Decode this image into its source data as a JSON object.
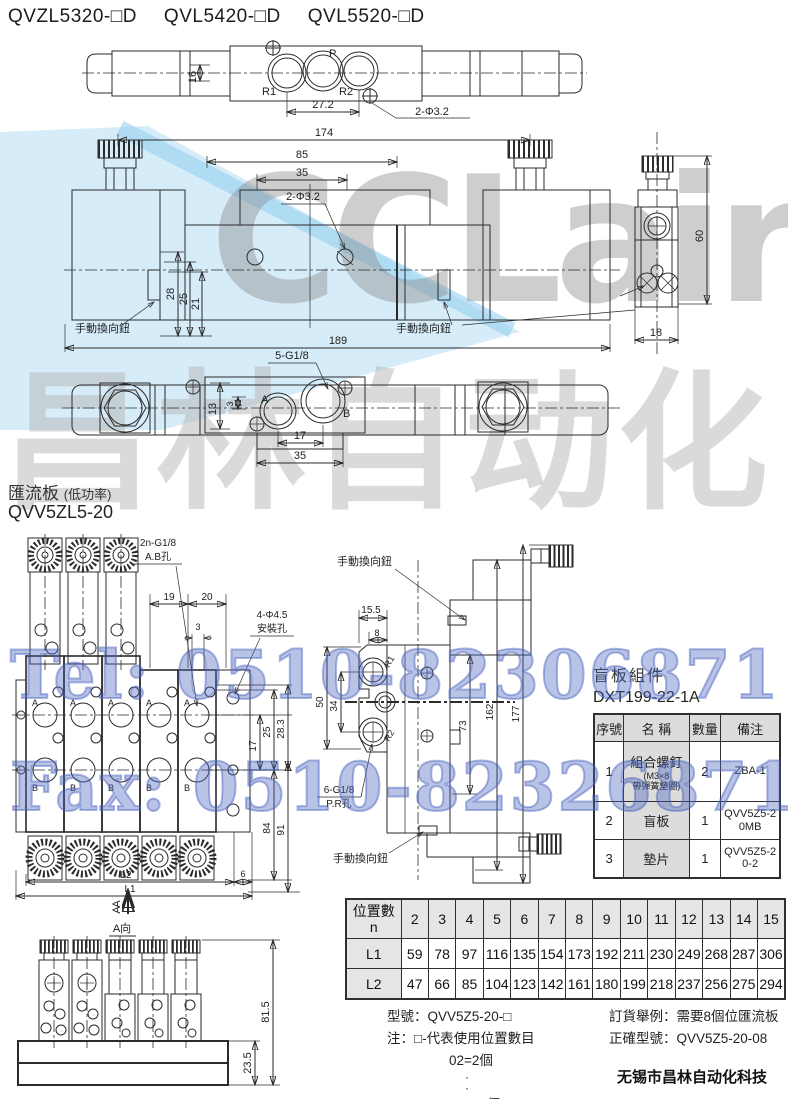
{
  "header": {
    "models": [
      "QVZL5320-□D",
      "QVL5420-□D",
      "QVL5520-□D"
    ]
  },
  "watermarks": {
    "brand": "CCLair",
    "brand_cn": "昌林自动化",
    "tel": "Tel: 0510-82306871",
    "fax": "Fax: 0510-82326871"
  },
  "colors": {
    "line": "#2b2b2b",
    "swoosh": "#cfe9f8",
    "swoosh_edge": "#8fcdef",
    "table_gray": "#e5e5e5",
    "contact_blue": "#4860bc"
  },
  "top_view": {
    "port_r1": "R1",
    "port_p": "P",
    "port_r2": "R2",
    "dim16": "16",
    "dim272": "27.2",
    "holes": "2-Φ3.2"
  },
  "front_view": {
    "dim174": "174",
    "dim85": "85",
    "dim35": "35",
    "holes": "2-Φ3.2",
    "dim28": "28",
    "dim25": "25",
    "dim21": "21",
    "dim189": "189",
    "knob_left": "手動換向鈕",
    "knob_right": "手動換向鈕"
  },
  "side_view": {
    "dim60": "60",
    "dim18": "18"
  },
  "bottom_view": {
    "thread": "5-G1/8",
    "port_a": "A",
    "port_b": "B",
    "dim13": "13",
    "dim3": "3",
    "dim17": "17",
    "dim35": "35"
  },
  "section": {
    "title": "匯流板",
    "note": "(低功率)",
    "model": "QVV5ZL5-20"
  },
  "manifold_top": {
    "thread": "2n-G1/8",
    "thread_sub": "A.B孔",
    "dim19": "19",
    "dim20": "20",
    "dim3": "3",
    "mount": "4-Φ4.5",
    "mount_sub": "安裝孔",
    "dim283": "28.3",
    "dim25": "25",
    "dim17": "17",
    "dim84": "84",
    "dim91": "91",
    "dimL2": "L2",
    "dim6": "6",
    "dimL1": "L1",
    "view_arrow": "A",
    "port_a": "A",
    "port_b": "B"
  },
  "manifold_side": {
    "knob_top": "手動換向鈕",
    "knob_bottom": "手動換向鈕",
    "dim155": "15.5",
    "dim8": "8",
    "dim50": "50",
    "dim34": "34",
    "dim73": "73",
    "dim162": "162",
    "dim177": "177",
    "port_r1": "R1",
    "port_p": "P",
    "port_r2": "R2",
    "thread": "6-G1/8",
    "thread_sub": "P.R孔"
  },
  "blank_plate": {
    "title": "盲板組件",
    "part_no": "DXT199-22-1A",
    "headers": [
      "序號",
      "名 稱",
      "數量",
      "備注"
    ],
    "rows": [
      {
        "no": "1",
        "name": "組合螺釘",
        "sub": "(M3×8",
        "sub2": "帶彈簧墊圈)",
        "qty": "2",
        "note": "ZBA-1"
      },
      {
        "no": "2",
        "name": "盲板",
        "qty": "1",
        "note": "QVV5Z5-20MB"
      },
      {
        "no": "3",
        "name": "墊片",
        "qty": "1",
        "note": "QVV5Z5-20-2"
      }
    ]
  },
  "a_view": {
    "label": "A向",
    "arrow": "A",
    "dim815": "81.5",
    "dim235": "23.5"
  },
  "size_table": {
    "corner": "位置數",
    "corner_sub": "n",
    "row1": "L1",
    "row2": "L2",
    "positions": [
      "2",
      "3",
      "4",
      "5",
      "6",
      "7",
      "8",
      "9",
      "10",
      "11",
      "12",
      "13",
      "14",
      "15"
    ],
    "L1": [
      "59",
      "78",
      "97",
      "116",
      "135",
      "154",
      "173",
      "192",
      "211",
      "230",
      "249",
      "268",
      "287",
      "306"
    ],
    "L2": [
      "47",
      "66",
      "85",
      "104",
      "123",
      "142",
      "161",
      "180",
      "199",
      "218",
      "237",
      "256",
      "275",
      "294"
    ]
  },
  "ordering": {
    "model": "型號：QVV5Z5-20-□",
    "note": "注：□-代表使用位置數目",
    "ex_first": "02=2個",
    "dots": "·\n·",
    "ex_last": "15=15個",
    "example": "訂貨舉例：需要8個位匯流板",
    "correct": "正確型號：QVV5Z5-20-08"
  },
  "footer": {
    "company": "无锡市昌林自动化科技"
  }
}
